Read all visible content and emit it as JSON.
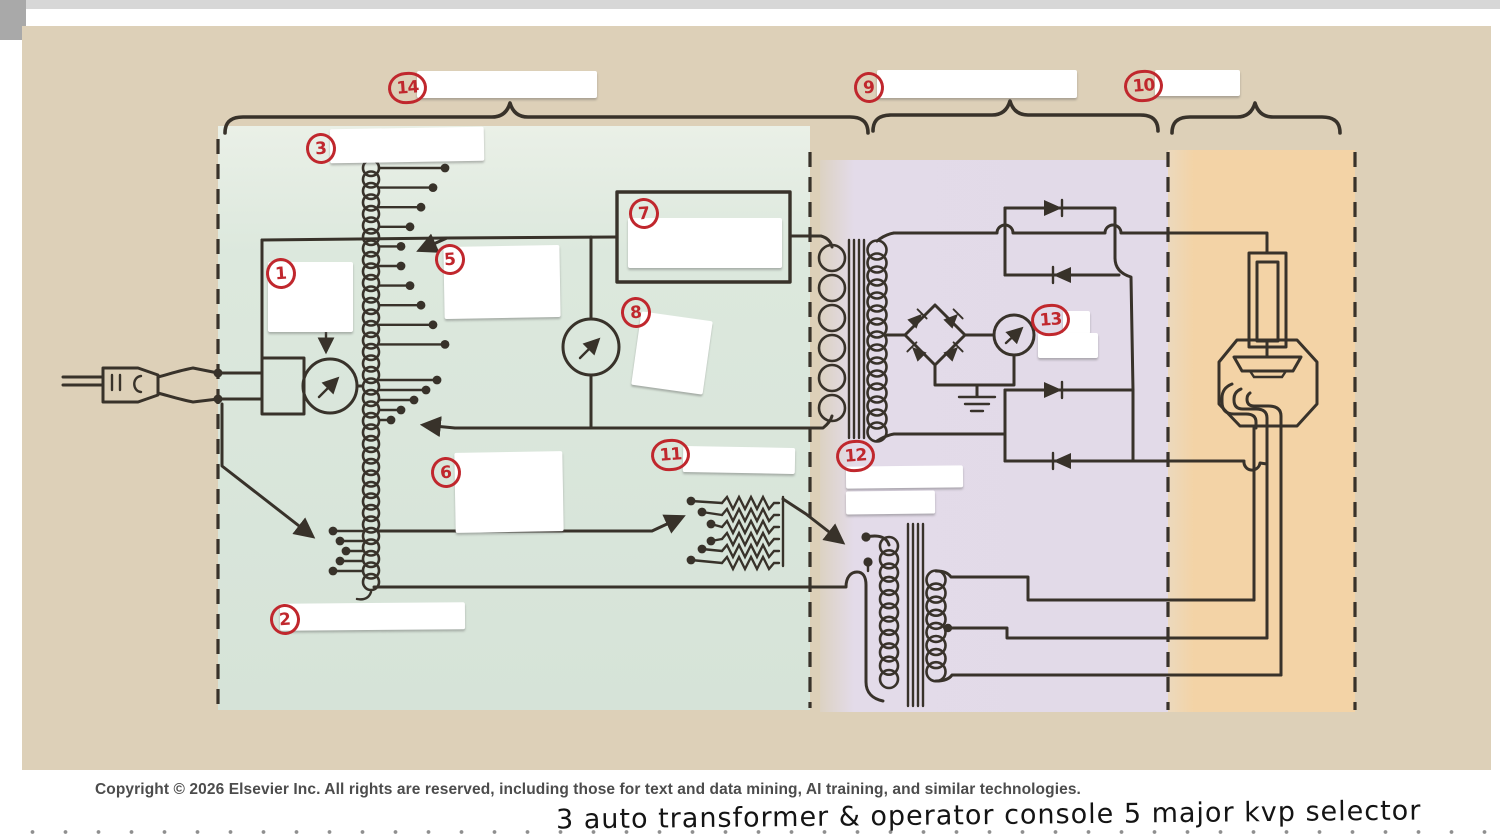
{
  "figure": {
    "labels": {
      "l1": "1",
      "l2": "2",
      "l3": "3",
      "l5": "5",
      "l6": "6",
      "l7": "7",
      "l8": "8",
      "l9": "9",
      "l10": "10",
      "l11": "11",
      "l12": "12",
      "l13": "13",
      "l14": "14"
    },
    "copyright": "Copyright © 2026 Elsevier Inc. All rights are reserved, including those for text and data mining, AI training, and similar technologies.",
    "handwriting": "3 auto transformer  &  operator console   5 major kvp selector",
    "colors": {
      "background_tan": "#ddd0b8",
      "section_green": "#d9e5da",
      "section_purple": "#e3dbe9",
      "section_orange": "#f3d3a6",
      "line": "#38322a",
      "annotation_red": "#c0272d"
    }
  }
}
